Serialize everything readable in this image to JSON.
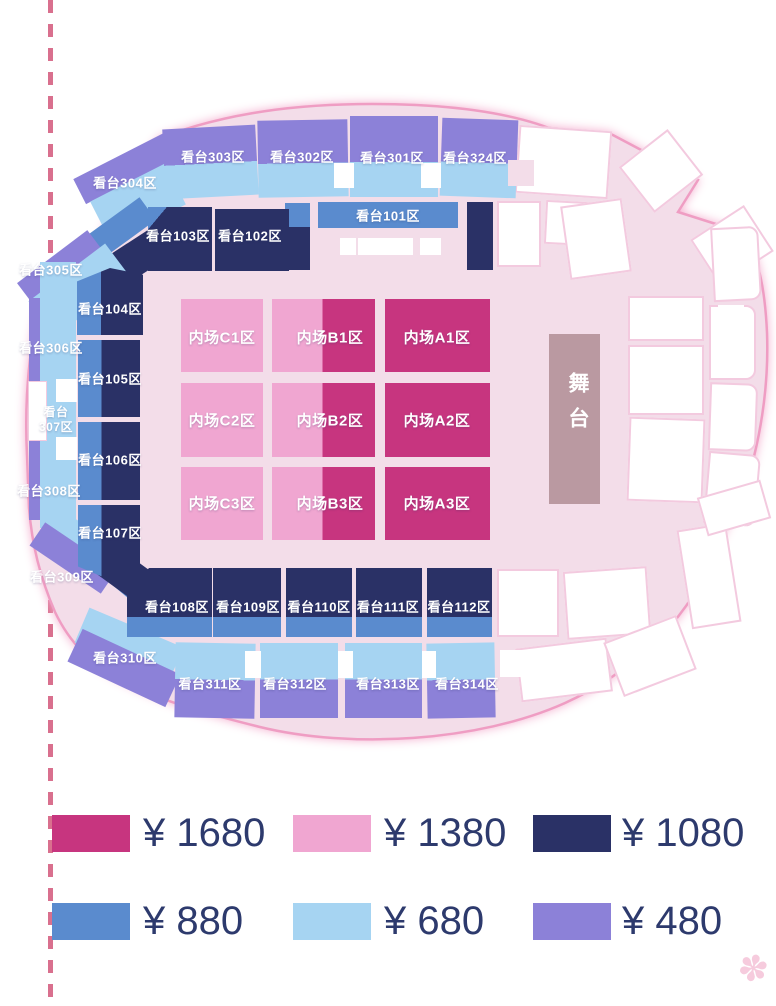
{
  "stage": {
    "label": "舞台"
  },
  "field": {
    "c1": "内场C1区",
    "b1": "内场B1区",
    "a1": "内场A1区",
    "c2": "内场C2区",
    "b2": "内场B2区",
    "a2": "内场A2区",
    "c3": "内场C3区",
    "b3": "内场B3区",
    "a3": "内场A3区"
  },
  "stands": {
    "s101": "看台101区",
    "s102": "看台102区",
    "s103": "看台103区",
    "s104": "看台104区",
    "s105": "看台105区",
    "s106": "看台106区",
    "s107": "看台107区",
    "s108": "看台108区",
    "s109": "看台109区",
    "s110": "看台110区",
    "s111": "看台111区",
    "s112": "看台112区",
    "s301": "看台301区",
    "s302": "看台302区",
    "s303": "看台303区",
    "s304": "看台304区",
    "s305": "看台305区",
    "s306": "看台306区",
    "s307_line1": "看台",
    "s307_line2": "307区",
    "s308": "看台308区",
    "s309": "看台309区",
    "s310": "看台310区",
    "s311": "看台311区",
    "s312": "看台312区",
    "s313": "看台313区",
    "s314": "看台314区",
    "s324": "看台324区"
  },
  "legend": {
    "items": [
      {
        "price": "¥ 1680",
        "color": "#C7357F"
      },
      {
        "price": "¥ 1380",
        "color": "#F0A6D1"
      },
      {
        "price": "¥ 1080",
        "color": "#2A3166"
      },
      {
        "price": "¥ 880",
        "color": "#5A8BCE"
      },
      {
        "price": "¥ 680",
        "color": "#A6D4F2"
      },
      {
        "price": "¥ 480",
        "color": "#8C81D8"
      }
    ]
  },
  "colors": {
    "arena_background": "#F3DDE9",
    "arena_outline": "#EF9DC3",
    "stage": "#BA99A1",
    "legend_text": "#2D3A6D",
    "dashed_line": "#D9708E"
  }
}
